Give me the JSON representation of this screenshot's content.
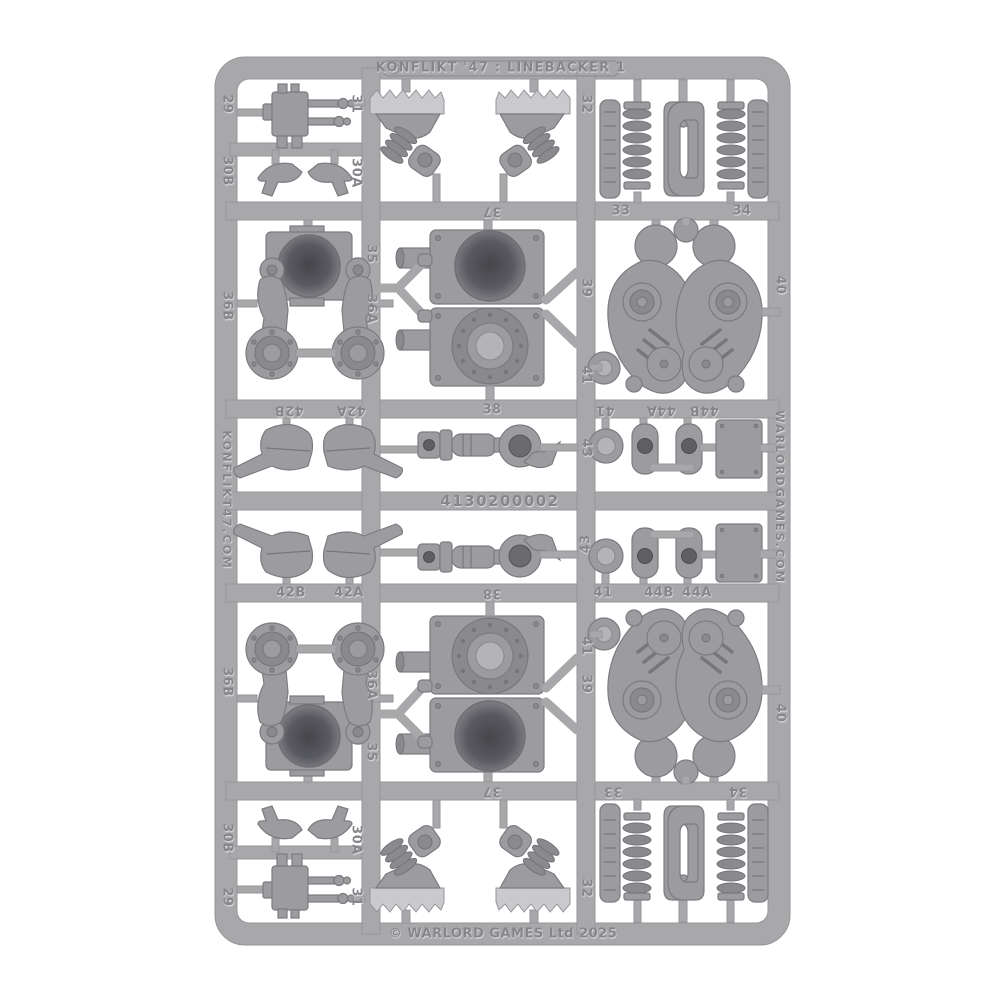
{
  "photo": {
    "subject": "plastic-model-sprue",
    "background_color": "#ffffff",
    "plastic_color": "#a8a8ab"
  },
  "sprue": {
    "title": "KONFLIKT '47 : LINEBACKER 1",
    "copyright": "© WARLORD GAMES Ltd 2025",
    "product_code": "4130200002",
    "left_rail_text": "KONFLIKT47.COM",
    "right_rail_text": "WARLORDGAMES.COM",
    "part_numbers": {
      "29": "29",
      "30A": "30A",
      "30B": "30B",
      "31": "31",
      "32": "32",
      "33": "33",
      "34": "34",
      "35": "35",
      "36A": "36A",
      "36B": "36B",
      "37": "37",
      "38": "38",
      "39": "39",
      "40": "40",
      "41": "41",
      "42A": "42A",
      "42B": "42B",
      "43": "43",
      "44A": "44A",
      "44B": "44B"
    }
  }
}
